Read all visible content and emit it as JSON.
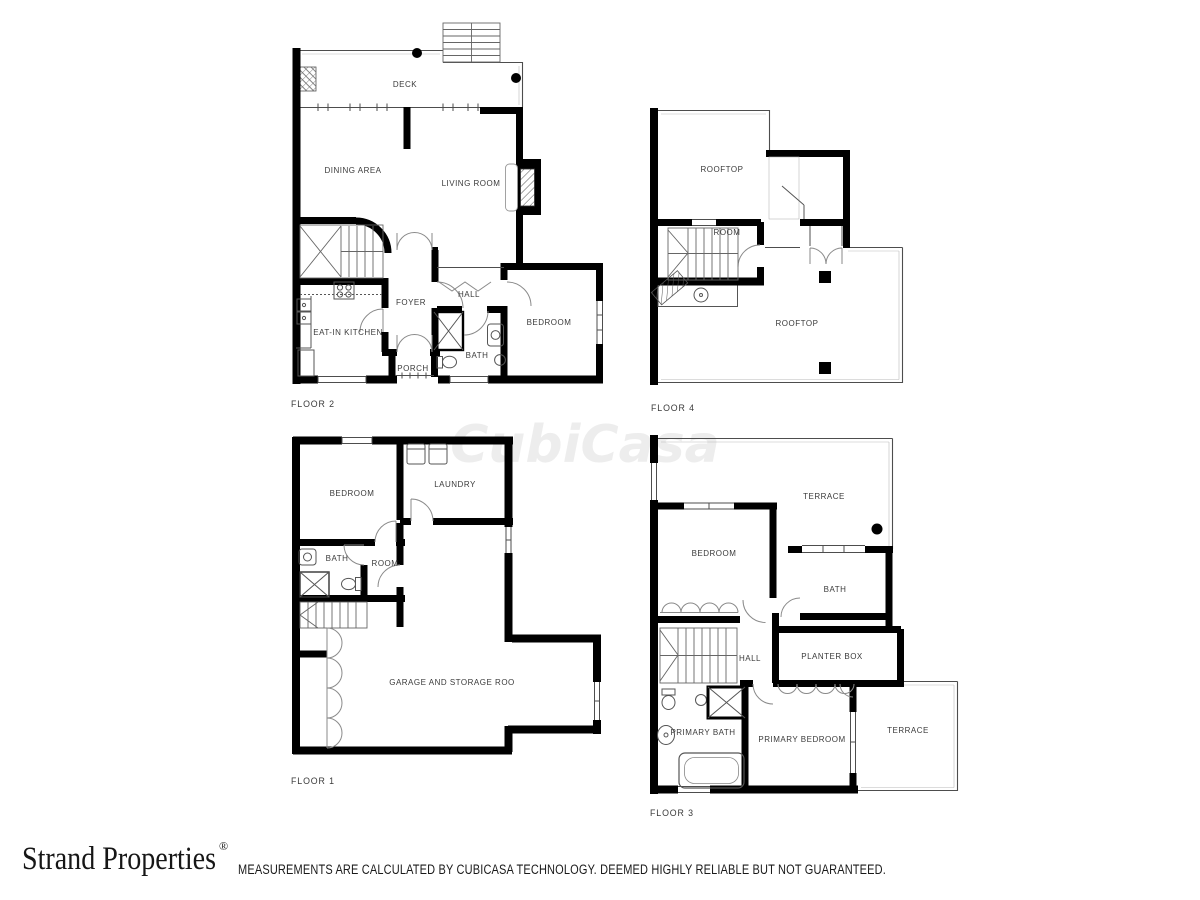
{
  "watermark": "CubiCasa",
  "floors": {
    "floor2": {
      "label": "FLOOR 2",
      "rooms": {
        "deck": "DECK",
        "dining": "DINING AREA",
        "living": "LIVING ROOM",
        "kitchen": "EAT-IN KITCHEN",
        "foyer": "FOYER",
        "hall": "HALL",
        "bath": "BATH",
        "bedroom": "BEDROOM",
        "porch": "PORCH"
      }
    },
    "floor4": {
      "label": "FLOOR 4",
      "rooms": {
        "rooftop_upper": "ROOFTOP",
        "room": "ROOM",
        "rooftop_lower": "ROOFTOP"
      }
    },
    "floor1": {
      "label": "FLOOR 1",
      "rooms": {
        "bedroom": "BEDROOM",
        "laundry": "LAUNDRY",
        "bath": "BATH",
        "room": "ROOM",
        "garage": "GARAGE AND STORAGE ROO"
      }
    },
    "floor3": {
      "label": "FLOOR 3",
      "rooms": {
        "terrace_upper": "TERRACE",
        "bedroom": "BEDROOM",
        "bath": "BATH",
        "planter": "PLANTER BOX",
        "hall": "HALL",
        "primary_bath": "PRIMARY BATH",
        "primary_bedroom": "PRIMARY BEDROOM",
        "terrace_lower": "TERRACE"
      }
    }
  },
  "footer": {
    "brand": "Strand Properties",
    "registered": "®",
    "disclaimer": "MEASUREMENTS ARE CALCULATED BY CUBICASA TECHNOLOGY. DEEMED HIGHLY RELIABLE BUT NOT GUARANTEED."
  },
  "colors": {
    "wall": "#000000",
    "label": "#3b3b3b",
    "background": "#ffffff"
  }
}
